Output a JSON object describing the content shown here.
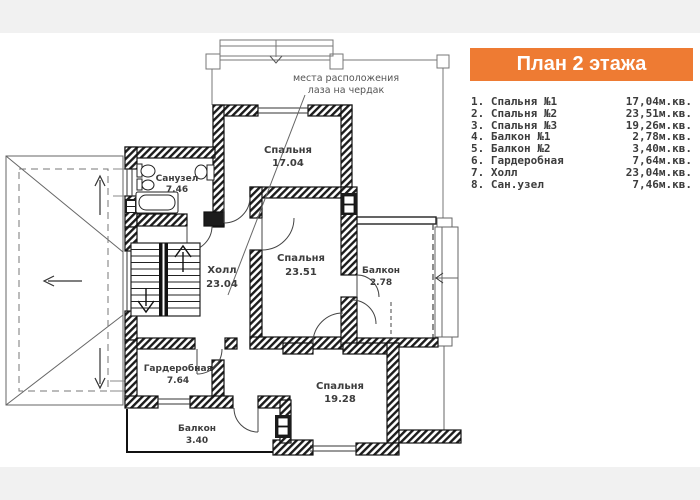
{
  "header": {
    "title": "План 2 этажа"
  },
  "legend": {
    "items": [
      {
        "label": "1. Спальня №1",
        "area": "17,04м.кв."
      },
      {
        "label": "2. Спальня №2",
        "area": "23,51м.кв."
      },
      {
        "label": "3. Спальня №3",
        "area": "19,26м.кв."
      },
      {
        "label": "4. Балкон №1",
        "area": "2,78м.кв."
      },
      {
        "label": "5. Балкон №2",
        "area": "3,40м.кв."
      },
      {
        "label": "6. Гардеробная",
        "area": "7,64м.кв."
      },
      {
        "label": "7. Холл",
        "area": "23,04м.кв."
      },
      {
        "label": "8. Сан.узел",
        "area": "7,46м.кв."
      }
    ]
  },
  "plan": {
    "annotation": {
      "line1": "места расположения",
      "line2": "лаза на чердак"
    },
    "rooms": {
      "bedroom1": {
        "name": "Спальня",
        "area": "17.04"
      },
      "bathroom": {
        "name": "Санузел",
        "area": "7.46"
      },
      "hall": {
        "name": "Холл",
        "area": "23.04"
      },
      "bedroom2": {
        "name": "Спальня",
        "area": "23.51"
      },
      "balcony1": {
        "name": "Балкон",
        "area": "2.78"
      },
      "wardrobe": {
        "name": "Гардеробная",
        "area": "7.64"
      },
      "balcony2": {
        "name": "Балкон",
        "area": "3.40"
      },
      "bedroom3": {
        "name": "Спальня",
        "area": "19.28"
      }
    }
  },
  "colors": {
    "accent_orange": "#EE7B33",
    "band_grey": "#F1F1F1",
    "wall_black": "#1C1C1C",
    "line_grey": "#777777",
    "text_dark": "#3C3C3C"
  }
}
